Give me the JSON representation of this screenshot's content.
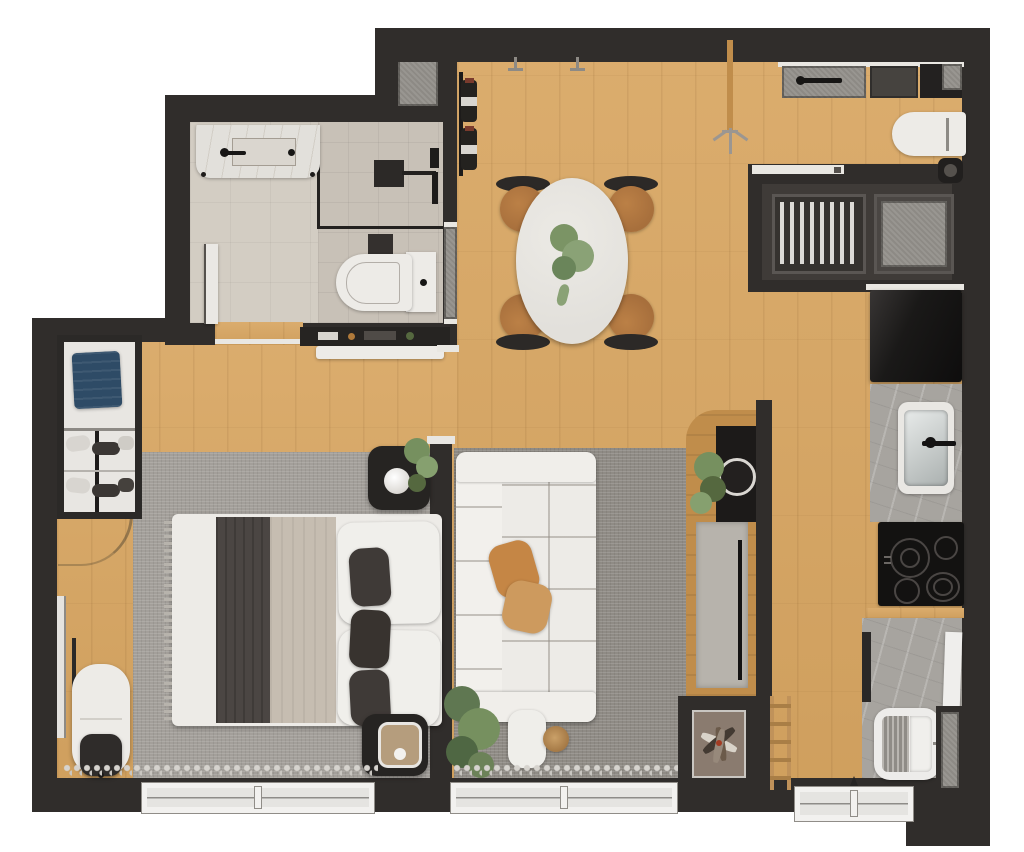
{
  "canvas": {
    "width": 1024,
    "height": 852
  },
  "palette": {
    "background": "#ffffff",
    "wall": "#302d2b",
    "wall-light": "#4a4643",
    "wood": "#d8a662",
    "wood-dark": "#c08d4b",
    "bath-floor": "#d3cdc3",
    "shower-floor": "#c8c1b7",
    "balcony-floor": "#3f3b38",
    "rug-bedroom": "#a39f9a",
    "rug-living": "#8f8b85",
    "soft-white": "#edebe7",
    "warm-white": "#e2e0db",
    "counter-grey": "#a7a49f",
    "mat-grey": "#8d8a85",
    "appliance-black": "#1b1918",
    "appliance-grey": "#46433f",
    "steel": "#c6cbca",
    "charcoal": "#4b4643",
    "duvet-beige": "#c6bdb1",
    "cushion-dark": "#3f3a37",
    "pillow-tan": "#c58645",
    "chair-wood": "#a76f3c",
    "plant-green": "#76905f",
    "plant-green-dark": "#55683f",
    "denim-blue": "#2e4b66",
    "terracotta": "#a33b22",
    "niche-floor": "#8a7b6f"
  },
  "scene": {
    "type": "apartment-floor-plan-top-view",
    "rooms": [
      {
        "name": "bathroom",
        "objects": [
          "vanity-counter",
          "vanity-sink",
          "faucet",
          "shower-glass",
          "shower-head",
          "shower-mixer",
          "toilet",
          "frosted-niche",
          "bathroom-door"
        ]
      },
      {
        "name": "entry-shaft",
        "objects": [
          "doormat"
        ]
      },
      {
        "name": "dining-area",
        "objects": [
          "oval-dining-table",
          "dining-chair",
          "dining-chair",
          "dining-chair",
          "dining-chair",
          "table-plant",
          "wine-rack",
          "wall-hooks",
          "console-shelf",
          "entry-bench",
          "coat-stand"
        ]
      },
      {
        "name": "laundry-area",
        "objects": [
          "washing-machine",
          "dark-appliance",
          "ironing-board",
          "bucket",
          "service-shaft"
        ]
      },
      {
        "name": "technical-balcony",
        "objects": [
          "sliding-door",
          "drying-rack",
          "condenser-mat"
        ]
      },
      {
        "name": "kitchen",
        "objects": [
          "refrigerator",
          "kitchen-sink",
          "sink-faucet",
          "cooktop-4-burners",
          "oven-handle",
          "laundry-tank",
          "leaning-board",
          "wall-niche",
          "ladder"
        ]
      },
      {
        "name": "bedroom",
        "objects": [
          "wardrobe",
          "folded-clothes",
          "shoe-rack",
          "floor-mirror",
          "armchair",
          "ottoman",
          "area-rug",
          "double-bed",
          "charcoal-runner",
          "beige-duvet",
          "pillows",
          "dark-cushions",
          "nightstand-lamp",
          "nightstand-tray",
          "sheer-curtain",
          "window"
        ]
      },
      {
        "name": "living-room",
        "objects": [
          "area-rug",
          "sofa",
          "tan-pillows",
          "floor-plant",
          "plant-pot",
          "wood-stool",
          "tv-half-wall",
          "tv",
          "sideboard",
          "planter-shelf",
          "decor-niche",
          "dried-arrangement",
          "sheer-curtain",
          "window"
        ]
      }
    ],
    "window_count": 3,
    "burner_count": 4,
    "chair_count": 4
  }
}
